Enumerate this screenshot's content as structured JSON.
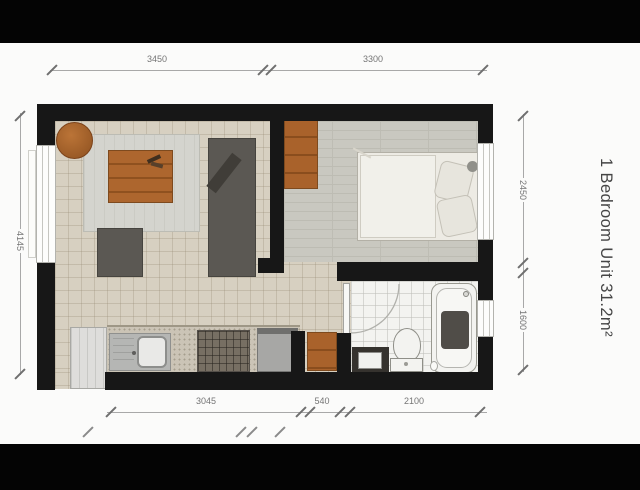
{
  "title": {
    "text": "1 Bedroom Unit 31.2m²"
  },
  "dimensions": {
    "top": [
      "3450",
      "3300"
    ],
    "bottom": [
      "3045",
      "540",
      "2100"
    ],
    "left": [
      "4145"
    ],
    "right": [
      "2450",
      "1600"
    ]
  },
  "colors": {
    "wall": "#171717",
    "wood_furniture": "#a9622b",
    "dark_furniture": "#5b5853",
    "tile_floor": "#d7d0c1",
    "wood_floor": "#c9c8c0",
    "bath_floor": "#f3f3f0",
    "rug": "#d4d4ce",
    "dimension_line": "#a8a8a8",
    "letterbox": "#040404"
  }
}
